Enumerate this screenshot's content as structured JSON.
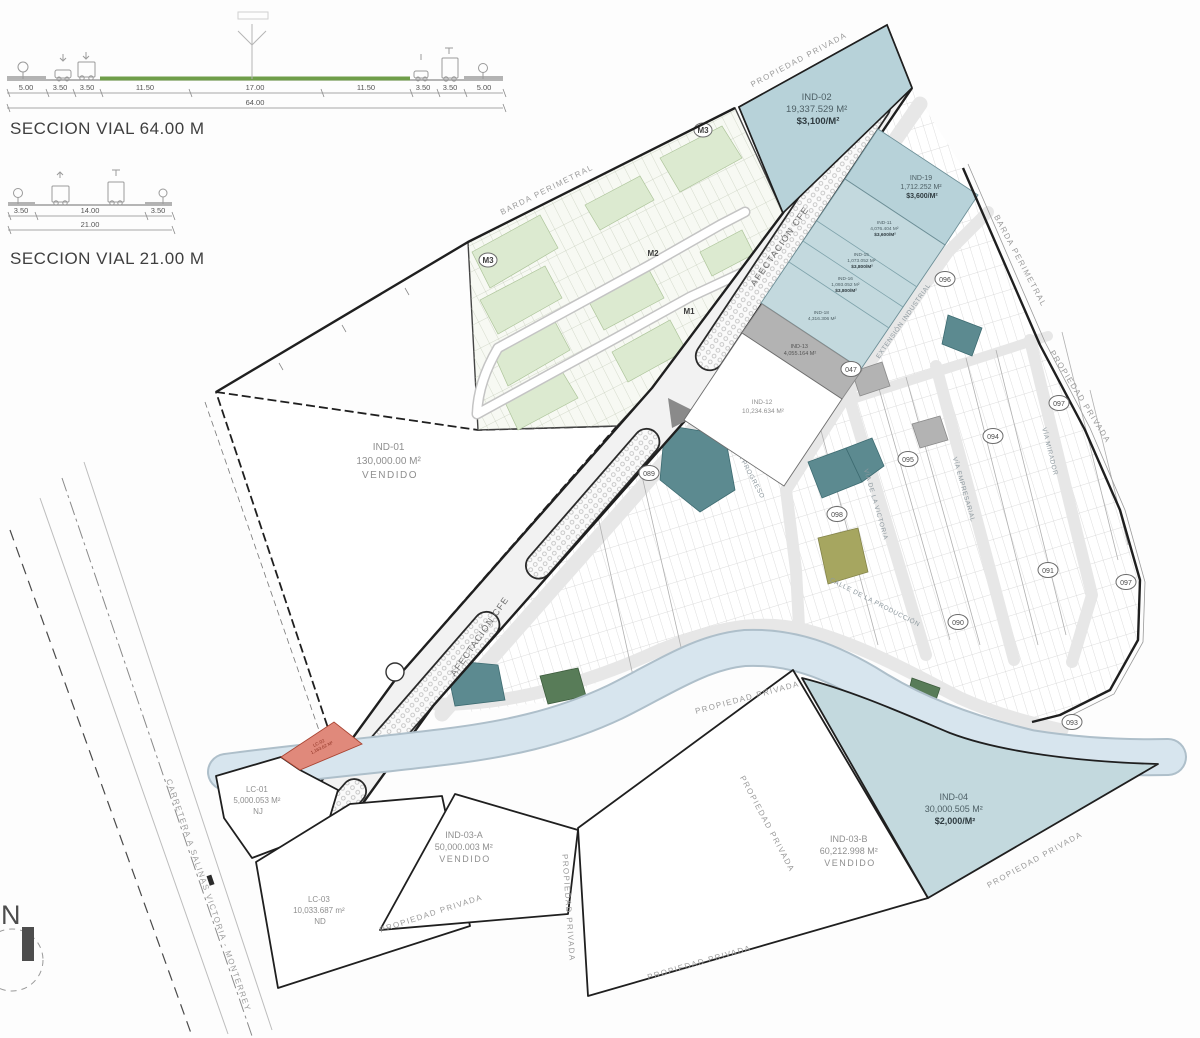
{
  "palette": {
    "teal": "#b7d2d9",
    "teal_light": "#c3d9de",
    "teal_dark": "#5c8a90",
    "green_dark": "#587c58",
    "olive": "#a6a660",
    "green_light": "#dcead0",
    "gray_lot": "#b3b3b3",
    "red_lot": "#e0897b",
    "river": "#d7e5ee",
    "river_edge": "#aebfca",
    "street": "#e7e7e7",
    "boundary": "#1f1f1f"
  },
  "sections": [
    {
      "title": "SECCION VIAL   64.00 M",
      "dims": [
        "5.00",
        "3.50",
        "3.50",
        "11.50",
        "17.00",
        "11.50",
        "3.50",
        "3.50",
        "5.00"
      ],
      "total": "64.00"
    },
    {
      "title": "SECCION VIAL   21.00 M",
      "dims": [
        "3.50",
        "14.00",
        "3.50"
      ],
      "total": "21.00"
    }
  ],
  "compass": {
    "north": "N"
  },
  "parcels": {
    "ind01": {
      "id": "IND-01",
      "area": "130,000.00 M²",
      "status": "VENDIDO"
    },
    "ind02": {
      "id": "IND-02",
      "area": "19,337.529 M²",
      "price": "$3,100/M²"
    },
    "ind19": {
      "id": "IND-19",
      "area": "1,712.252 M²",
      "price": "$3,600/M²"
    },
    "ind11": {
      "id": "IND-11",
      "area": "4,076.404 M²",
      "price": "$3,600/M²"
    },
    "ind15": {
      "id": "IND-15",
      "area": "1,073.052 M²",
      "price": "$3,800/M²"
    },
    "ind16": {
      "id": "IND-16",
      "area": "1,093.052 M²",
      "price": "$3,800/M²"
    },
    "ind18": {
      "id": "IND-18",
      "area": "4,316.306 M²"
    },
    "ind13": {
      "id": "IND-13",
      "area": "4,055.164 M²"
    },
    "ind12": {
      "id": "IND-12",
      "area": "10,234.634 M²"
    },
    "ind03a": {
      "id": "IND-03-A",
      "area": "50,000.003 M²",
      "status": "VENDIDO"
    },
    "ind03b": {
      "id": "IND-03-B",
      "area": "60,212.998 M²",
      "status": "VENDIDO"
    },
    "ind04": {
      "id": "IND-04",
      "area": "30,000.505 M²",
      "price": "$2,000/M²"
    },
    "lc01": {
      "id": "LC-01",
      "area": "5,000.053 M²",
      "status": "NJ"
    },
    "lc02": {
      "id": "LC-02",
      "area": "1,163.62 M²"
    },
    "lc03": {
      "id": "LC-03",
      "area": "10,033.687 m²",
      "status": "ND"
    }
  },
  "labels": {
    "afectacion": "AFECTACIÓN CFE",
    "barda": "BARDA PERIMETRAL",
    "propiedad": "PROPIEDAD PRIVADA",
    "carretera": "CARRETERA A SALINAS VICTORIA - MONTERREY"
  },
  "streets": {
    "progreso": "VÍA PROGRESO",
    "victoria": "VÍA DE LA VICTORIA",
    "empresarial": "VÍA EMPRESARIAL",
    "mirador": "VÍA MIRADOR",
    "produccion": "CALLE DE LA PRODUCCIÓN",
    "industrial": "EXTENSIÓN INDUSTRIAL"
  },
  "markers": {
    "circles": [
      "047",
      "089",
      "094",
      "095",
      "096",
      "097",
      "098",
      "091",
      "090",
      "093",
      "097"
    ],
    "zones": [
      "M1",
      "M2",
      "M3",
      "M3"
    ]
  }
}
